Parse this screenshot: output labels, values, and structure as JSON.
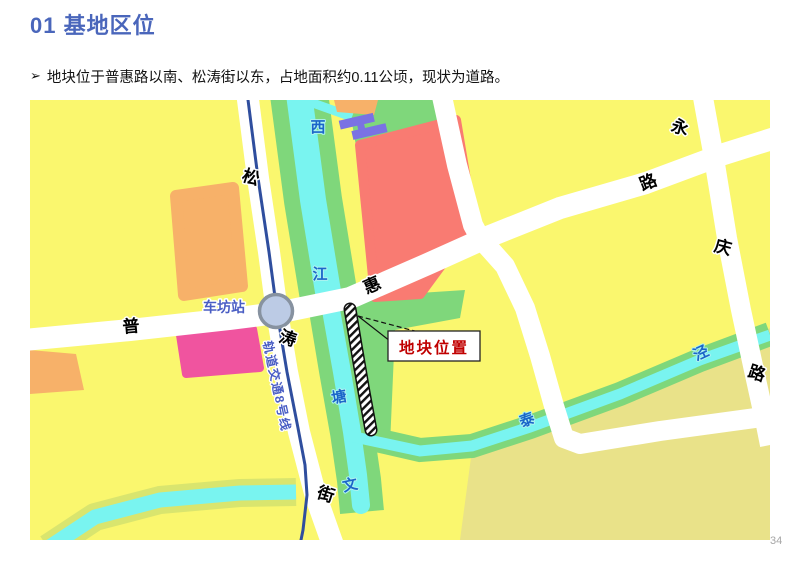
{
  "header": {
    "title": "01 基地区位",
    "accent_color": "#4A66BB"
  },
  "intro": {
    "marker": "➢",
    "text": "地块位于普惠路以南、松涛街以东，占地面积约0.11公顷，现状为道路。"
  },
  "map": {
    "station_label": "车坊站",
    "metro_line_label": "轨道交通8号线",
    "callout_label": "地块位置",
    "road_labels": [
      {
        "text": "松"
      },
      {
        "text": "涛"
      },
      {
        "text": "街"
      },
      {
        "text": "普"
      },
      {
        "text": "惠"
      },
      {
        "text": "路"
      },
      {
        "text": "永"
      },
      {
        "text": "庆"
      },
      {
        "text": "路"
      }
    ],
    "water_labels": [
      {
        "text": "西"
      },
      {
        "text": "江"
      },
      {
        "text": "塘"
      },
      {
        "text": "文"
      },
      {
        "text": "泰"
      },
      {
        "text": "泾"
      }
    ],
    "colors": {
      "block_yellow": "#FAF76E",
      "block_khaki": "#E9E289",
      "block_orange": "#F7B169",
      "block_pink": "#F0549F",
      "block_red": "#F97B72",
      "greenbelt": "#7FD77B",
      "water_cyan": "#79F4F0",
      "channel_bank_olive": "#D9E56E",
      "building_purple": "#7A72E3",
      "road_white": "#FFFFFF",
      "metro_blue": "#2F4E9E",
      "roundabout_fill": "#BCCBE5",
      "callout_red": "#C00000",
      "water_label_blue": "#1B66C9",
      "station_label_blue": "#4A5EC4"
    }
  },
  "footer": {
    "page_number": "34"
  }
}
